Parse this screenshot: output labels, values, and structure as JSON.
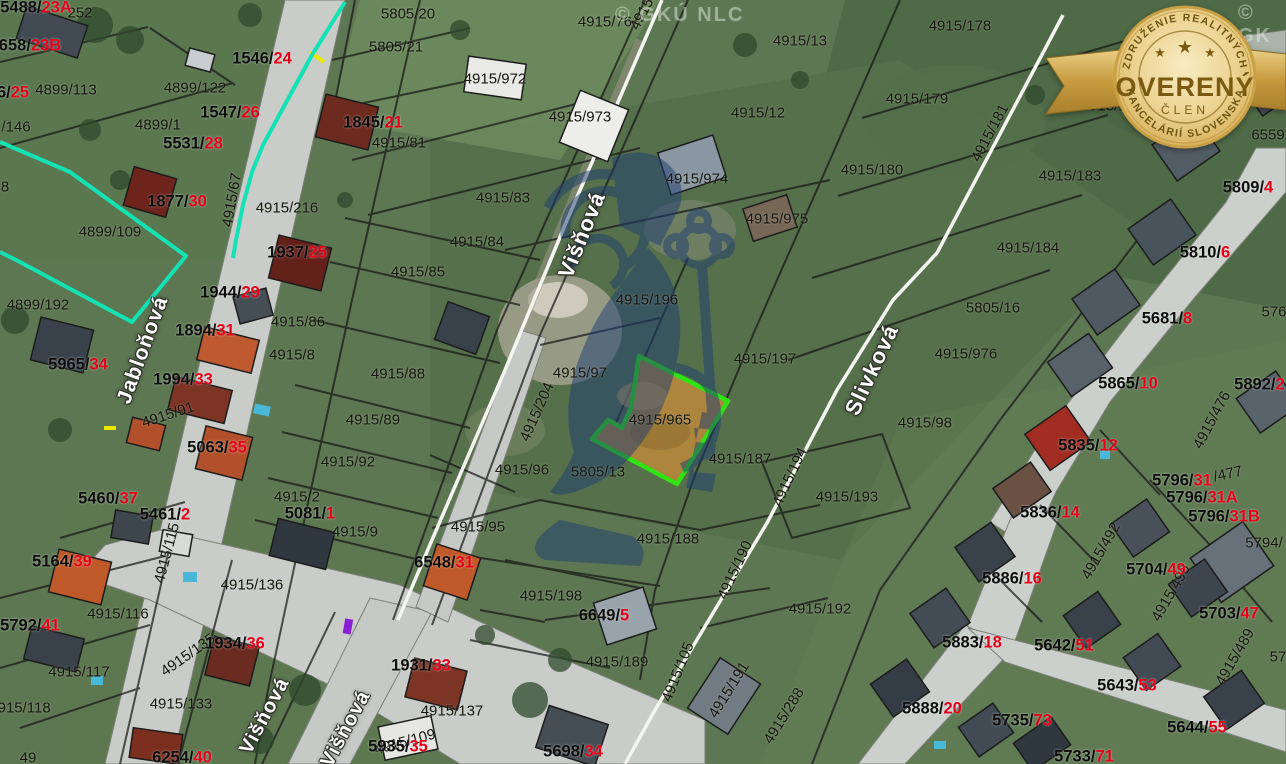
{
  "map": {
    "selected_parcel": {
      "id": "4915/965",
      "outline_color": "#2fe412",
      "fill_color": "#b5873c"
    },
    "highlight_teal": "#12e2b4",
    "red_suffix_color": "#e50019",
    "watermark_full": "© GKÚ NLC",
    "watermark_corner": "© GK",
    "street_labels": [
      {
        "text": "Višňová",
        "x": 582,
        "y": 235,
        "r": -68,
        "size": 22
      },
      {
        "text": "Jabloňová",
        "x": 143,
        "y": 350,
        "r": -70,
        "size": 21
      },
      {
        "text": "Slivková",
        "x": 872,
        "y": 370,
        "r": -65,
        "size": 22
      },
      {
        "text": "Višňová",
        "x": 265,
        "y": 716,
        "r": -62,
        "size": 20
      },
      {
        "text": "Višňová",
        "x": 346,
        "y": 729,
        "r": -62,
        "size": 20
      }
    ],
    "parcel_labels": [
      {
        "text": "5805/20",
        "x": 408,
        "y": 14
      },
      {
        "text": "5805/21",
        "x": 396,
        "y": 47
      },
      {
        "text": "4915/76",
        "x": 605,
        "y": 22
      },
      {
        "text": "4915/13",
        "x": 800,
        "y": 41
      },
      {
        "text": "4915/12",
        "x": 758,
        "y": 113
      },
      {
        "text": "4915/972",
        "x": 495,
        "y": 79
      },
      {
        "text": "4915/973",
        "x": 580,
        "y": 117
      },
      {
        "text": "4915/974",
        "x": 697,
        "y": 179
      },
      {
        "text": "4915/975",
        "x": 777,
        "y": 219
      },
      {
        "text": "4915/178",
        "x": 960,
        "y": 26
      },
      {
        "text": "4915/179",
        "x": 917,
        "y": 99
      },
      {
        "text": "4915/180",
        "x": 872,
        "y": 170
      },
      {
        "text": "4915/182",
        "x": 1112,
        "y": 106
      },
      {
        "text": "4915/183",
        "x": 1070,
        "y": 176
      },
      {
        "text": "4915/184",
        "x": 1028,
        "y": 248
      },
      {
        "text": "6559",
        "x": 1268,
        "y": 135
      },
      {
        "text": "252",
        "x": 80,
        "y": 13
      },
      {
        "text": "4899/113",
        "x": 66,
        "y": 90
      },
      {
        "text": "4899/122",
        "x": 195,
        "y": 88
      },
      {
        "text": "4899/1",
        "x": 158,
        "y": 125
      },
      {
        "text": "/146",
        "x": 16,
        "y": 127
      },
      {
        "text": "8",
        "x": 5,
        "y": 187
      },
      {
        "text": "4899/109",
        "x": 110,
        "y": 232
      },
      {
        "text": "4899/192",
        "x": 38,
        "y": 305
      },
      {
        "text": "4915/216",
        "x": 287,
        "y": 208
      },
      {
        "text": "4915/81",
        "x": 399,
        "y": 143
      },
      {
        "text": "4915/83",
        "x": 503,
        "y": 198
      },
      {
        "text": "4915/84",
        "x": 477,
        "y": 242
      },
      {
        "text": "4915/85",
        "x": 418,
        "y": 272
      },
      {
        "text": "4915/86",
        "x": 298,
        "y": 322
      },
      {
        "text": "4915/8",
        "x": 292,
        "y": 355
      },
      {
        "text": "4915/88",
        "x": 398,
        "y": 374
      },
      {
        "text": "4915/89",
        "x": 373,
        "y": 420
      },
      {
        "text": "4915/92",
        "x": 348,
        "y": 462
      },
      {
        "text": "4915/9",
        "x": 355,
        "y": 532
      },
      {
        "text": "4915/95",
        "x": 478,
        "y": 527
      },
      {
        "text": "4915/96",
        "x": 522,
        "y": 470
      },
      {
        "text": "4915/2",
        "x": 297,
        "y": 497
      },
      {
        "text": "4915/196",
        "x": 647,
        "y": 300
      },
      {
        "text": "4915/97",
        "x": 580,
        "y": 373
      },
      {
        "text": "4915/197",
        "x": 765,
        "y": 359
      },
      {
        "text": "4915/965",
        "x": 660,
        "y": 420
      },
      {
        "text": "4915/187",
        "x": 740,
        "y": 459
      },
      {
        "text": "5805/13",
        "x": 598,
        "y": 472
      },
      {
        "text": "4915/193",
        "x": 847,
        "y": 497
      },
      {
        "text": "4915/98",
        "x": 925,
        "y": 423
      },
      {
        "text": "4915/976",
        "x": 966,
        "y": 354
      },
      {
        "text": "5805/16",
        "x": 993,
        "y": 308
      },
      {
        "text": "4915/188",
        "x": 668,
        "y": 539
      },
      {
        "text": "4915/198",
        "x": 551,
        "y": 596
      },
      {
        "text": "4915/189",
        "x": 617,
        "y": 662
      },
      {
        "text": "4915/137",
        "x": 452,
        "y": 711
      },
      {
        "text": "4915/136",
        "x": 252,
        "y": 585
      },
      {
        "text": "4915/116",
        "x": 118,
        "y": 614
      },
      {
        "text": "4915/117",
        "x": 79,
        "y": 672
      },
      {
        "text": "4915/118",
        "x": 20,
        "y": 708
      },
      {
        "text": "4915/133",
        "x": 181,
        "y": 704
      },
      {
        "text": "4915/192",
        "x": 820,
        "y": 609
      },
      {
        "text": "49",
        "x": 28,
        "y": 758
      },
      {
        "text": "576",
        "x": 1274,
        "y": 312
      },
      {
        "text": "57",
        "x": 1278,
        "y": 657
      },
      {
        "text": "5794/",
        "x": 1264,
        "y": 543
      },
      {
        "text": "/477",
        "x": 1228,
        "y": 474,
        "r": -12
      },
      {
        "text": "4915",
        "x": 642,
        "y": 14,
        "r": -62
      },
      {
        "text": "4915/67",
        "x": 232,
        "y": 200,
        "r": -80
      },
      {
        "text": "4915/181",
        "x": 990,
        "y": 133,
        "r": -62
      },
      {
        "text": "4915/204",
        "x": 537,
        "y": 412,
        "r": -66
      },
      {
        "text": "4915/194",
        "x": 790,
        "y": 477,
        "r": -65
      },
      {
        "text": "4915/190",
        "x": 735,
        "y": 570,
        "r": -65
      },
      {
        "text": "4915/105",
        "x": 678,
        "y": 672,
        "r": -68
      },
      {
        "text": "4915/191",
        "x": 729,
        "y": 690,
        "r": -58
      },
      {
        "text": "4915/288",
        "x": 784,
        "y": 716,
        "r": -58
      },
      {
        "text": "4915/115",
        "x": 167,
        "y": 553,
        "r": -75
      },
      {
        "text": "4915/135",
        "x": 188,
        "y": 655,
        "r": -35
      },
      {
        "text": "4915/109",
        "x": 405,
        "y": 742,
        "r": -15
      },
      {
        "text": "4915/91",
        "x": 168,
        "y": 415,
        "r": -18
      },
      {
        "text": "4915/476",
        "x": 1212,
        "y": 420,
        "r": -62
      },
      {
        "text": "4915/492",
        "x": 1101,
        "y": 551,
        "r": -60
      },
      {
        "text": "4915/490",
        "x": 1171,
        "y": 593,
        "r": -60
      },
      {
        "text": "4915/489",
        "x": 1235,
        "y": 657,
        "r": -60
      }
    ],
    "house_number_labels": [
      {
        "prefix": "5488/",
        "suffix": "23A",
        "x": 36,
        "y": 8
      },
      {
        "prefix": "658/",
        "suffix": "23B",
        "x": 30,
        "y": 46
      },
      {
        "prefix": "6/",
        "suffix": "25",
        "x": 13,
        "y": 93
      },
      {
        "prefix": "1546/",
        "suffix": "24",
        "x": 262,
        "y": 59
      },
      {
        "prefix": "1547/",
        "suffix": "26",
        "x": 230,
        "y": 113
      },
      {
        "prefix": "5531/",
        "suffix": "28",
        "x": 193,
        "y": 144
      },
      {
        "prefix": "1845/",
        "suffix": "21",
        "x": 373,
        "y": 123
      },
      {
        "prefix": "1877/",
        "suffix": "30",
        "x": 177,
        "y": 202
      },
      {
        "prefix": "1937/",
        "suffix": "25",
        "x": 297,
        "y": 253
      },
      {
        "prefix": "1944/",
        "suffix": "29",
        "x": 230,
        "y": 293
      },
      {
        "prefix": "1894/",
        "suffix": "31",
        "x": 205,
        "y": 331
      },
      {
        "prefix": "5965/",
        "suffix": "34",
        "x": 78,
        "y": 365
      },
      {
        "prefix": "1994/",
        "suffix": "33",
        "x": 183,
        "y": 380
      },
      {
        "prefix": "5063/",
        "suffix": "35",
        "x": 217,
        "y": 448
      },
      {
        "prefix": "5460/",
        "suffix": "37",
        "x": 108,
        "y": 499
      },
      {
        "prefix": "5461/",
        "suffix": "2",
        "x": 165,
        "y": 515
      },
      {
        "prefix": "5081/",
        "suffix": "1",
        "x": 310,
        "y": 514
      },
      {
        "prefix": "5164/",
        "suffix": "39",
        "x": 62,
        "y": 562
      },
      {
        "prefix": "5792/",
        "suffix": "41",
        "x": 30,
        "y": 626
      },
      {
        "prefix": "1934/",
        "suffix": "36",
        "x": 235,
        "y": 644
      },
      {
        "prefix": "6254/",
        "suffix": "40",
        "x": 182,
        "y": 758
      },
      {
        "prefix": "1931/",
        "suffix": "33",
        "x": 421,
        "y": 666
      },
      {
        "prefix": "5935/",
        "suffix": "35",
        "x": 398,
        "y": 747
      },
      {
        "prefix": "6548/",
        "suffix": "31",
        "x": 444,
        "y": 563
      },
      {
        "prefix": "6649/",
        "suffix": "5",
        "x": 604,
        "y": 616
      },
      {
        "prefix": "5698/",
        "suffix": "34",
        "x": 573,
        "y": 752
      },
      {
        "prefix": "5809/",
        "suffix": "4",
        "x": 1248,
        "y": 188
      },
      {
        "prefix": "5810/",
        "suffix": "6",
        "x": 1205,
        "y": 253
      },
      {
        "prefix": "5681/",
        "suffix": "8",
        "x": 1167,
        "y": 319
      },
      {
        "prefix": "5865/",
        "suffix": "10",
        "x": 1128,
        "y": 384
      },
      {
        "prefix": "5835/",
        "suffix": "12",
        "x": 1088,
        "y": 446
      },
      {
        "prefix": "5892/",
        "suffix": "21",
        "x": 1264,
        "y": 385
      },
      {
        "prefix": "5836/",
        "suffix": "14",
        "x": 1050,
        "y": 513
      },
      {
        "prefix": "5796/",
        "suffix": "31",
        "x": 1182,
        "y": 481
      },
      {
        "prefix": "5796/",
        "suffix": "31A",
        "x": 1202,
        "y": 498
      },
      {
        "prefix": "5796/",
        "suffix": "31B",
        "x": 1224,
        "y": 517
      },
      {
        "prefix": "5704/",
        "suffix": "49",
        "x": 1156,
        "y": 570
      },
      {
        "prefix": "5703/",
        "suffix": "47",
        "x": 1229,
        "y": 614
      },
      {
        "prefix": "5886/",
        "suffix": "16",
        "x": 1012,
        "y": 579
      },
      {
        "prefix": "5883/",
        "suffix": "18",
        "x": 972,
        "y": 643
      },
      {
        "prefix": "5642/",
        "suffix": "51",
        "x": 1064,
        "y": 646
      },
      {
        "prefix": "5643/",
        "suffix": "53",
        "x": 1127,
        "y": 686
      },
      {
        "prefix": "5888/",
        "suffix": "20",
        "x": 932,
        "y": 709
      },
      {
        "prefix": "5735/",
        "suffix": "73",
        "x": 1022,
        "y": 721
      },
      {
        "prefix": "5733/",
        "suffix": "71",
        "x": 1084,
        "y": 757
      },
      {
        "prefix": "5644/",
        "suffix": "55",
        "x": 1197,
        "y": 728
      }
    ]
  },
  "badge": {
    "top_arc": "ZDRUŽENIE REALITNÝCH",
    "bottom_arc": "KANCELÁRIÍ SLOVENSKA",
    "title": "OVERENÝ",
    "subtitle": "ČLEN",
    "star": "★"
  }
}
